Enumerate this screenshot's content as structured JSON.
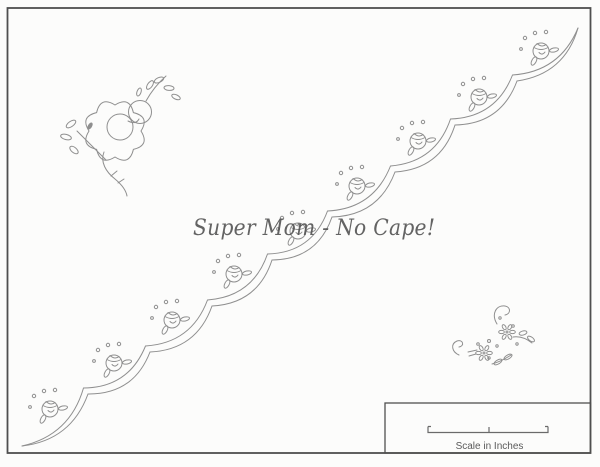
{
  "page": {
    "background": "#fcfcfb",
    "border_color": "#4f4f4f",
    "line_color": "#8f8f8f"
  },
  "watermark": {
    "text": "Super Mom - No Cape!",
    "color": "#4f4f4f"
  },
  "scale_box": {
    "label": "Scale in Inches"
  },
  "pattern": {
    "scallop_cusps": [
      [
        22,
        446
      ],
      [
        88,
        394
      ],
      [
        150,
        352
      ],
      [
        212,
        306
      ],
      [
        272,
        260
      ],
      [
        332,
        217
      ],
      [
        395,
        172
      ],
      [
        455,
        125
      ],
      [
        517,
        81
      ],
      [
        578,
        28
      ]
    ],
    "rosebud_positions": [
      [
        50,
        409
      ],
      [
        114,
        363
      ],
      [
        172,
        320
      ],
      [
        234,
        274
      ],
      [
        298,
        231
      ],
      [
        357,
        186
      ],
      [
        418,
        141
      ],
      [
        479,
        97
      ],
      [
        541,
        51
      ]
    ]
  }
}
